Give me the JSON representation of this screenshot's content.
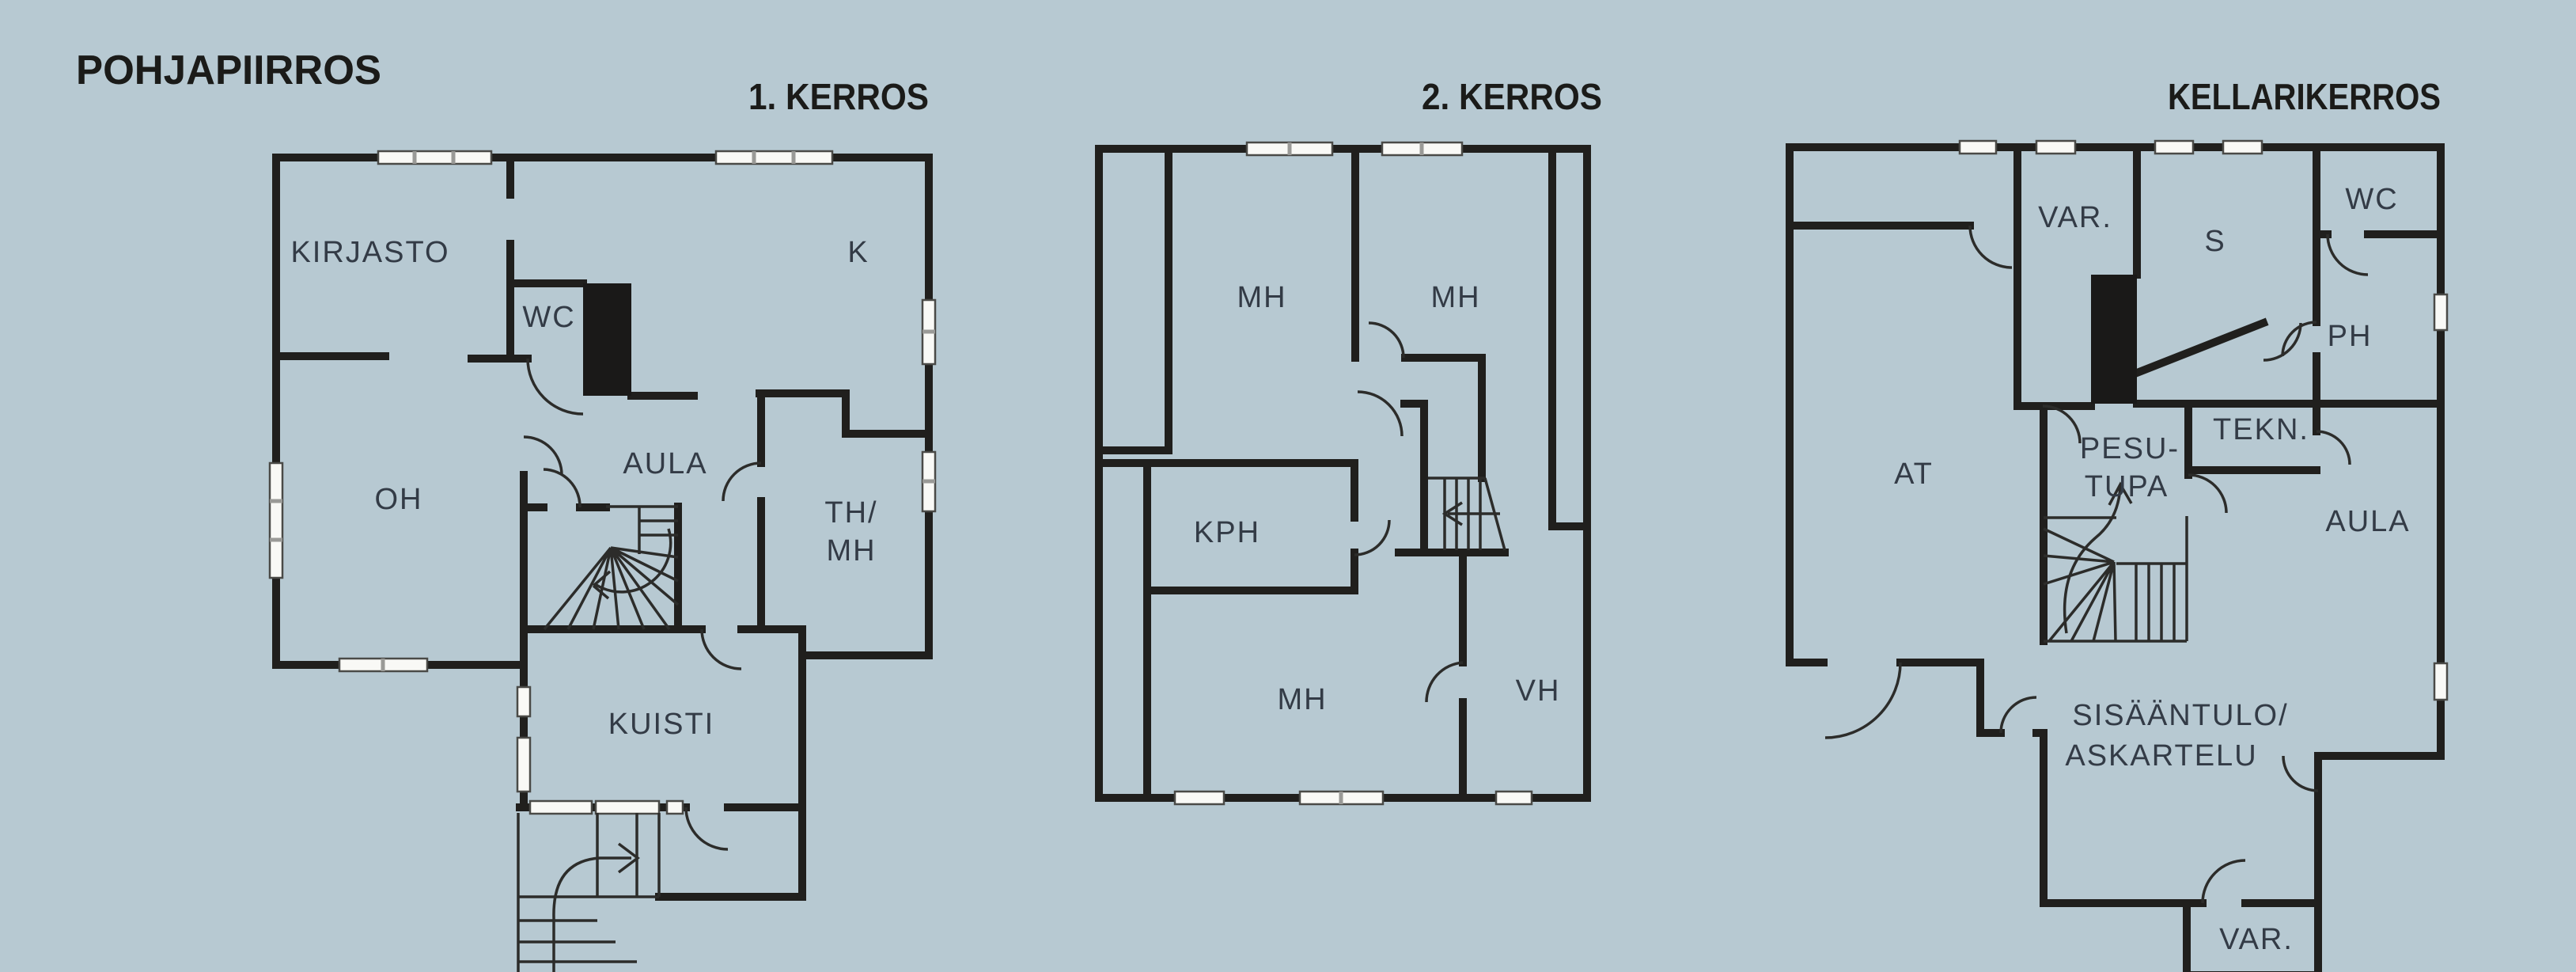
{
  "drawing_title": "POHJAPIIRROS",
  "colors": {
    "background": "#b7c9d2",
    "wall": "#201f1d",
    "label": "#333b46",
    "window": "#f9f9f6"
  },
  "floors": {
    "f1": {
      "title": "1. KERROS",
      "rooms": {
        "kirjasto": "KIRJASTO",
        "k": "K",
        "wc": "WC",
        "aula": "AULA",
        "oh": "OH",
        "th_line1": "TH/",
        "th_line2": "MH",
        "kuisti": "KUISTI"
      }
    },
    "f2": {
      "title": "2. KERROS",
      "rooms": {
        "mh1": "MH",
        "mh2": "MH",
        "kph": "KPH",
        "mh3": "MH",
        "vh": "VH"
      }
    },
    "f3": {
      "title": "KELLARIKERROS",
      "rooms": {
        "var1": "VAR.",
        "s": "S",
        "wc": "WC",
        "ph": "PH",
        "at": "AT",
        "pesu_line1": "PESU-",
        "pesu_line2": "TUPA",
        "tekn": "TEKN.",
        "aula": "AULA",
        "sis_line1": "SISÄÄNTULO/",
        "sis_line2": "ASKARTELU",
        "var2": "VAR."
      }
    }
  }
}
